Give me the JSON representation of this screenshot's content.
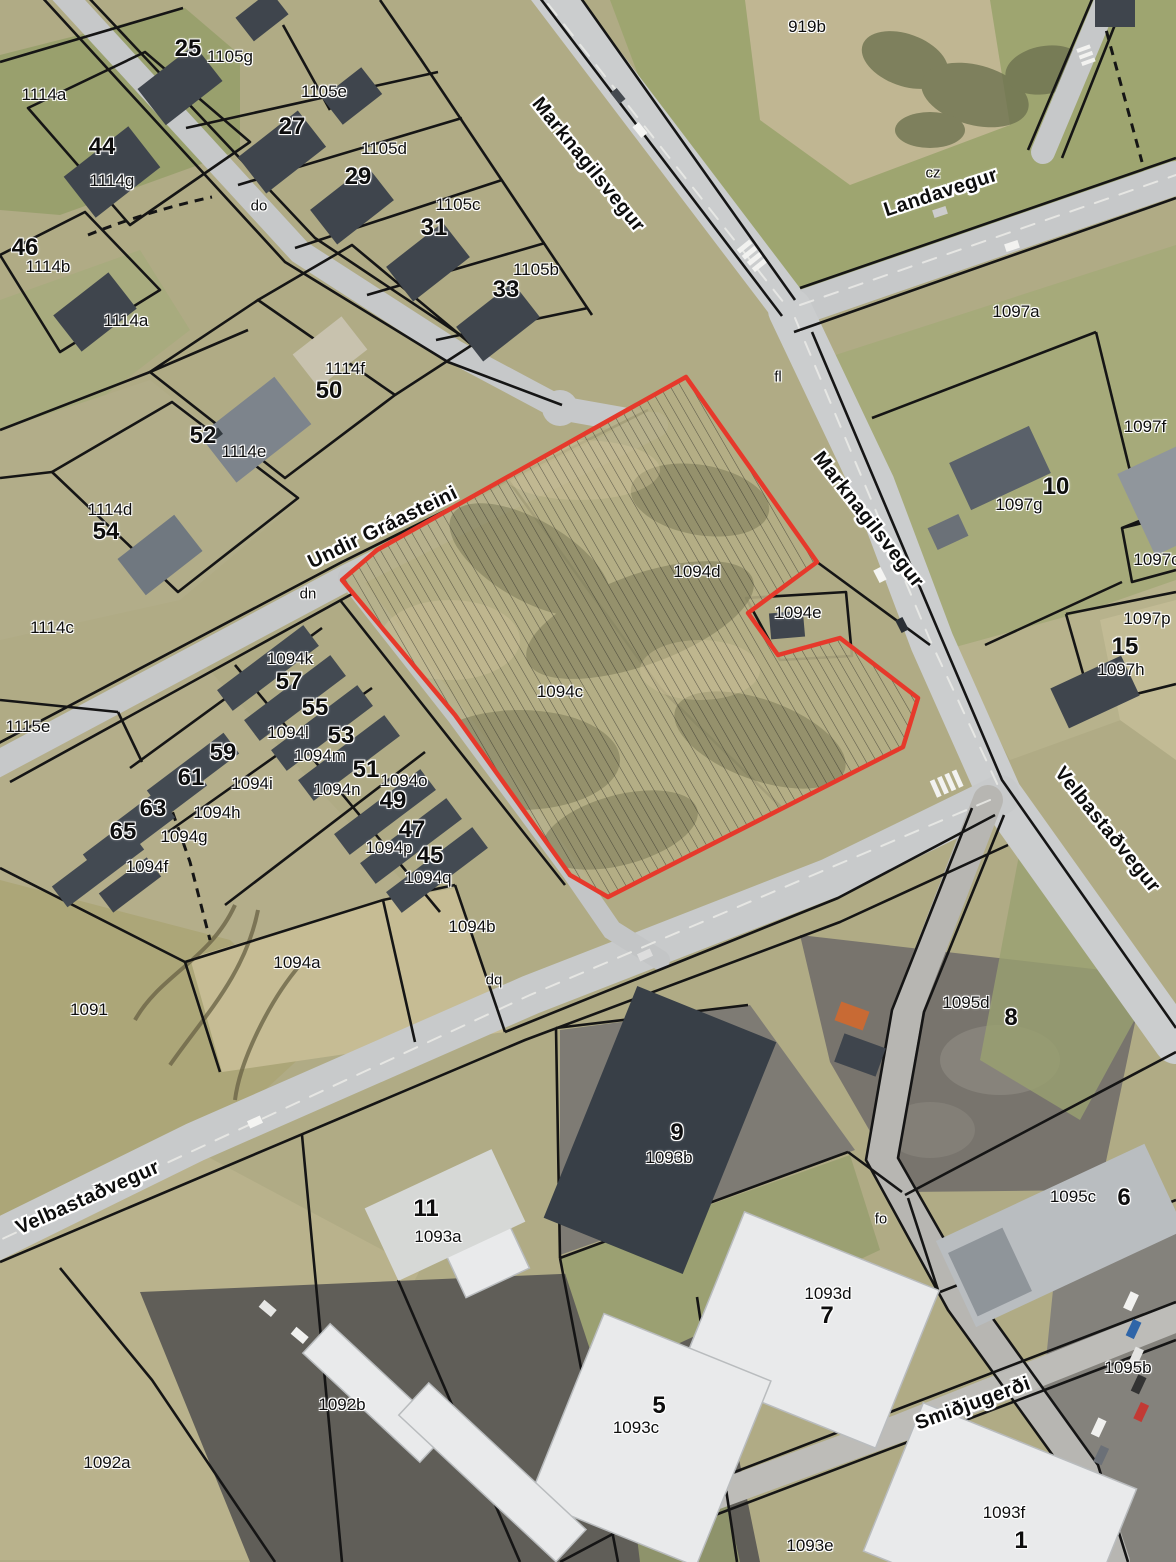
{
  "map": {
    "type": "aerial-cadastral-map",
    "highlight": {
      "color": "#e6392b",
      "hatched": true,
      "parcels": [
        "1094c",
        "1094d"
      ]
    },
    "streets": [
      "Marknagilsvegur",
      "Landavegur",
      "Undir Gráasteini",
      "Velbastaðvegur",
      "Smiðjugerði"
    ],
    "labels": [
      {
        "t": "25",
        "x": 188,
        "y": 49,
        "k": "n"
      },
      {
        "t": "27",
        "x": 292,
        "y": 127,
        "k": "n"
      },
      {
        "t": "29",
        "x": 358,
        "y": 177,
        "k": "n"
      },
      {
        "t": "31",
        "x": 434,
        "y": 228,
        "k": "n"
      },
      {
        "t": "33",
        "x": 506,
        "y": 290,
        "k": "n"
      },
      {
        "t": "44",
        "x": 102,
        "y": 147,
        "k": "n"
      },
      {
        "t": "46",
        "x": 25,
        "y": 248,
        "k": "n"
      },
      {
        "t": "50",
        "x": 329,
        "y": 391,
        "k": "n"
      },
      {
        "t": "52",
        "x": 203,
        "y": 436,
        "k": "n"
      },
      {
        "t": "54",
        "x": 106,
        "y": 532,
        "k": "n"
      },
      {
        "t": "57",
        "x": 289,
        "y": 682,
        "k": "n"
      },
      {
        "t": "55",
        "x": 315,
        "y": 708,
        "k": "n"
      },
      {
        "t": "53",
        "x": 341,
        "y": 736,
        "k": "n"
      },
      {
        "t": "59",
        "x": 223,
        "y": 753,
        "k": "n"
      },
      {
        "t": "61",
        "x": 191,
        "y": 778,
        "k": "n"
      },
      {
        "t": "51",
        "x": 366,
        "y": 770,
        "k": "n"
      },
      {
        "t": "63",
        "x": 153,
        "y": 809,
        "k": "n"
      },
      {
        "t": "65",
        "x": 123,
        "y": 832,
        "k": "n"
      },
      {
        "t": "49",
        "x": 393,
        "y": 801,
        "k": "n"
      },
      {
        "t": "47",
        "x": 412,
        "y": 830,
        "k": "n"
      },
      {
        "t": "45",
        "x": 430,
        "y": 856,
        "k": "n"
      },
      {
        "t": "10",
        "x": 1056,
        "y": 487,
        "k": "n"
      },
      {
        "t": "15",
        "x": 1125,
        "y": 647,
        "k": "n"
      },
      {
        "t": "8",
        "x": 1011,
        "y": 1018,
        "k": "n"
      },
      {
        "t": "9",
        "x": 677,
        "y": 1133,
        "k": "n"
      },
      {
        "t": "11",
        "x": 426,
        "y": 1209,
        "k": "n"
      },
      {
        "t": "6",
        "x": 1124,
        "y": 1198,
        "k": "n"
      },
      {
        "t": "7",
        "x": 827,
        "y": 1316,
        "k": "n"
      },
      {
        "t": "5",
        "x": 659,
        "y": 1406,
        "k": "n"
      },
      {
        "t": "1",
        "x": 1021,
        "y": 1541,
        "k": "n"
      },
      {
        "t": "1114a",
        "x": 44,
        "y": 95,
        "k": "i"
      },
      {
        "t": "1105g",
        "x": 230,
        "y": 57,
        "k": "i"
      },
      {
        "t": "1105e",
        "x": 324,
        "y": 92,
        "k": "i"
      },
      {
        "t": "1114g",
        "x": 112,
        "y": 181,
        "k": "i"
      },
      {
        "t": "1105d",
        "x": 384,
        "y": 149,
        "k": "i"
      },
      {
        "t": "1105c",
        "x": 458,
        "y": 205,
        "k": "i"
      },
      {
        "t": "1114b",
        "x": 48,
        "y": 267,
        "k": "i"
      },
      {
        "t": "1105b",
        "x": 536,
        "y": 270,
        "k": "i"
      },
      {
        "t": "1114a",
        "x": 126,
        "y": 321,
        "k": "i"
      },
      {
        "t": "1114f",
        "x": 345,
        "y": 369,
        "k": "i"
      },
      {
        "t": "1114e",
        "x": 244,
        "y": 452,
        "k": "i"
      },
      {
        "t": "1114d",
        "x": 110,
        "y": 510,
        "k": "i"
      },
      {
        "t": "1114c",
        "x": 52,
        "y": 628,
        "k": "i"
      },
      {
        "t": "1094k",
        "x": 290,
        "y": 659,
        "k": "i"
      },
      {
        "t": "1094l",
        "x": 288,
        "y": 733,
        "k": "i"
      },
      {
        "t": "1094m",
        "x": 320,
        "y": 756,
        "k": "i"
      },
      {
        "t": "1094i",
        "x": 252,
        "y": 784,
        "k": "i"
      },
      {
        "t": "1115e",
        "x": 28,
        "y": 727,
        "k": "i"
      },
      {
        "t": "1094n",
        "x": 337,
        "y": 790,
        "k": "i"
      },
      {
        "t": "1094o",
        "x": 404,
        "y": 781,
        "k": "i"
      },
      {
        "t": "1094h",
        "x": 217,
        "y": 813,
        "k": "i"
      },
      {
        "t": "1094g",
        "x": 184,
        "y": 837,
        "k": "i"
      },
      {
        "t": "1094p",
        "x": 389,
        "y": 848,
        "k": "i"
      },
      {
        "t": "1094f",
        "x": 147,
        "y": 867,
        "k": "i"
      },
      {
        "t": "1094q",
        "x": 428,
        "y": 878,
        "k": "i"
      },
      {
        "t": "919b",
        "x": 807,
        "y": 27,
        "k": "i"
      },
      {
        "t": "1097a",
        "x": 1016,
        "y": 312,
        "k": "i"
      },
      {
        "t": "1097g",
        "x": 1019,
        "y": 505,
        "k": "i"
      },
      {
        "t": "1097f",
        "x": 1145,
        "y": 427,
        "k": "i"
      },
      {
        "t": "1097o",
        "x": 1157,
        "y": 560,
        "k": "i"
      },
      {
        "t": "1097p",
        "x": 1147,
        "y": 619,
        "k": "i"
      },
      {
        "t": "1097h",
        "x": 1121,
        "y": 670,
        "k": "i"
      },
      {
        "t": "1094d",
        "x": 697,
        "y": 572,
        "k": "i"
      },
      {
        "t": "1094e",
        "x": 798,
        "y": 613,
        "k": "i"
      },
      {
        "t": "1094c",
        "x": 560,
        "y": 692,
        "k": "i"
      },
      {
        "t": "1094b",
        "x": 472,
        "y": 927,
        "k": "i"
      },
      {
        "t": "1094a",
        "x": 297,
        "y": 963,
        "k": "i"
      },
      {
        "t": "1091",
        "x": 89,
        "y": 1010,
        "k": "i"
      },
      {
        "t": "1095d",
        "x": 966,
        "y": 1003,
        "k": "i"
      },
      {
        "t": "1093b",
        "x": 669,
        "y": 1158,
        "k": "i"
      },
      {
        "t": "1093a",
        "x": 438,
        "y": 1237,
        "k": "i"
      },
      {
        "t": "1095c",
        "x": 1073,
        "y": 1197,
        "k": "i"
      },
      {
        "t": "1093d",
        "x": 828,
        "y": 1294,
        "k": "i"
      },
      {
        "t": "1095b",
        "x": 1128,
        "y": 1368,
        "k": "i"
      },
      {
        "t": "1092b",
        "x": 342,
        "y": 1405,
        "k": "i"
      },
      {
        "t": "1093c",
        "x": 636,
        "y": 1428,
        "k": "i"
      },
      {
        "t": "1092a",
        "x": 107,
        "y": 1463,
        "k": "i"
      },
      {
        "t": "1093f",
        "x": 1004,
        "y": 1513,
        "k": "i"
      },
      {
        "t": "1093e",
        "x": 810,
        "y": 1546,
        "k": "i"
      },
      {
        "t": "do",
        "x": 259,
        "y": 206,
        "k": "c"
      },
      {
        "t": "dn",
        "x": 308,
        "y": 594,
        "k": "c"
      },
      {
        "t": "cz",
        "x": 933,
        "y": 173,
        "k": "c"
      },
      {
        "t": "fl",
        "x": 778,
        "y": 377,
        "k": "c"
      },
      {
        "t": "dq",
        "x": 494,
        "y": 980,
        "k": "c"
      },
      {
        "t": "fo",
        "x": 881,
        "y": 1219,
        "k": "c"
      },
      {
        "t": "Marknagilsvegur",
        "x": 588,
        "y": 165,
        "k": "s",
        "r": 51
      },
      {
        "t": "Marknagilsvegur",
        "x": 868,
        "y": 520,
        "k": "s",
        "r": 52
      },
      {
        "t": "Landavegur",
        "x": 941,
        "y": 193,
        "k": "s",
        "r": -18
      },
      {
        "t": "Undir Gráasteini",
        "x": 383,
        "y": 528,
        "k": "s",
        "r": -26
      },
      {
        "t": "Velbastaðvegur",
        "x": 1107,
        "y": 830,
        "k": "s",
        "r": 51
      },
      {
        "t": "Velbastaðvegur",
        "x": 88,
        "y": 1198,
        "k": "s",
        "r": -24
      },
      {
        "t": "Smiðjugerði",
        "x": 973,
        "y": 1404,
        "k": "s",
        "r": -20
      }
    ]
  }
}
